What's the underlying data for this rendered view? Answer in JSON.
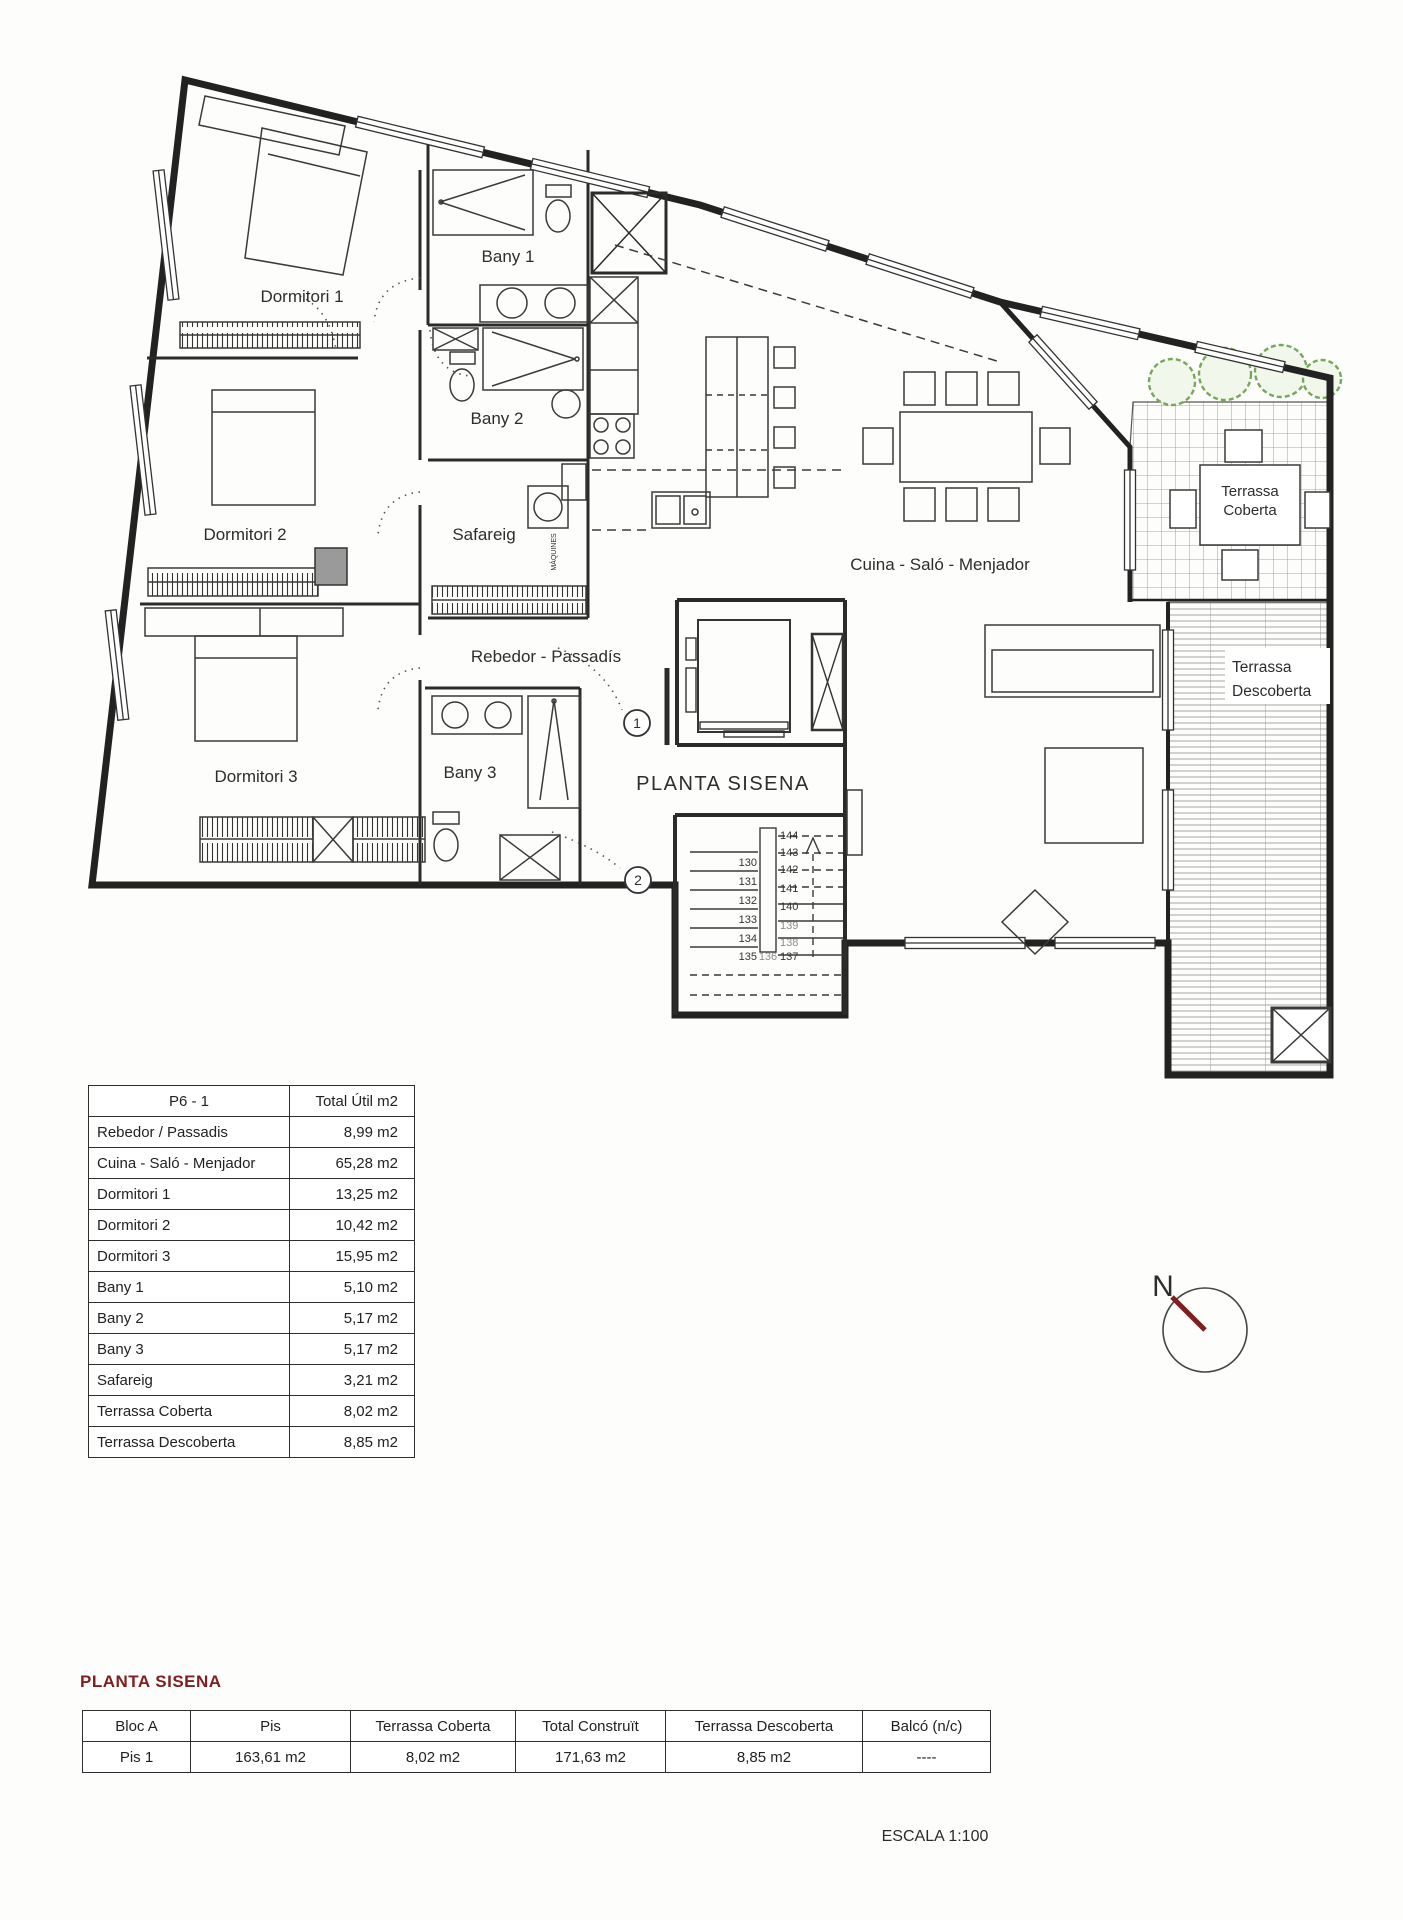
{
  "plan": {
    "rooms": {
      "dormitori1": "Dormitori 1",
      "dormitori2": "Dormitori 2",
      "dormitori3": "Dormitori 3",
      "bany1": "Bany 1",
      "bany2": "Bany 2",
      "bany3": "Bany 3",
      "safareig": "Safareig",
      "rebedor": "Rebedor - Passadís",
      "cuina": "Cuina - Saló - Menjador",
      "terrassa_coberta_l1": "Terrassa",
      "terrassa_coberta_l2": "Coberta",
      "terrassa_descoberta_l1": "Terrassa",
      "terrassa_descoberta_l2": "Descoberta",
      "maquines": "MÀQUINES"
    },
    "floor_label": "PLANTA SISENA",
    "markers": {
      "m1": "1",
      "m2": "2"
    },
    "compass_n": "N",
    "stairs": [
      "130",
      "131",
      "132",
      "133",
      "134",
      "135",
      "136",
      "137",
      "138",
      "139",
      "140",
      "141",
      "142",
      "143",
      "144"
    ]
  },
  "area_table": {
    "header": {
      "name": "P6 - 1",
      "total": "Total Útil m2"
    },
    "rows": [
      {
        "label": "Rebedor / Passadis",
        "value": "8,99 m2"
      },
      {
        "label": "Cuina - Saló - Menjador",
        "value": "65,28 m2"
      },
      {
        "label": "Dormitori 1",
        "value": "13,25 m2"
      },
      {
        "label": "Dormitori 2",
        "value": "10,42 m2"
      },
      {
        "label": "Dormitori 3",
        "value": "15,95 m2"
      },
      {
        "label": "Bany 1",
        "value": "5,10 m2"
      },
      {
        "label": "Bany 2",
        "value": "5,17 m2"
      },
      {
        "label": "Bany 3",
        "value": "5,17 m2"
      },
      {
        "label": "Safareig",
        "value": "3,21 m2"
      },
      {
        "label": "Terrassa Coberta",
        "value": "8,02 m2"
      },
      {
        "label": "Terrassa Descoberta",
        "value": "8,85 m2"
      }
    ]
  },
  "summary": {
    "heading": "PLANTA SISENA",
    "columns": [
      "Bloc A",
      "Pis",
      "Terrassa Coberta",
      "Total Construït",
      "Terrassa Descoberta",
      "Balcó (n/c)"
    ],
    "values": [
      "Pis 1",
      "163,61 m2",
      "8,02 m2",
      "171,63 m2",
      "8,85 m2",
      "----"
    ]
  },
  "scale_label": "ESCALA 1:100",
  "colors": {
    "wall": "#222222",
    "accent_maroon": "#7e2020",
    "tree_green": "#76a85a",
    "gray_box": "#9a9a9a"
  }
}
